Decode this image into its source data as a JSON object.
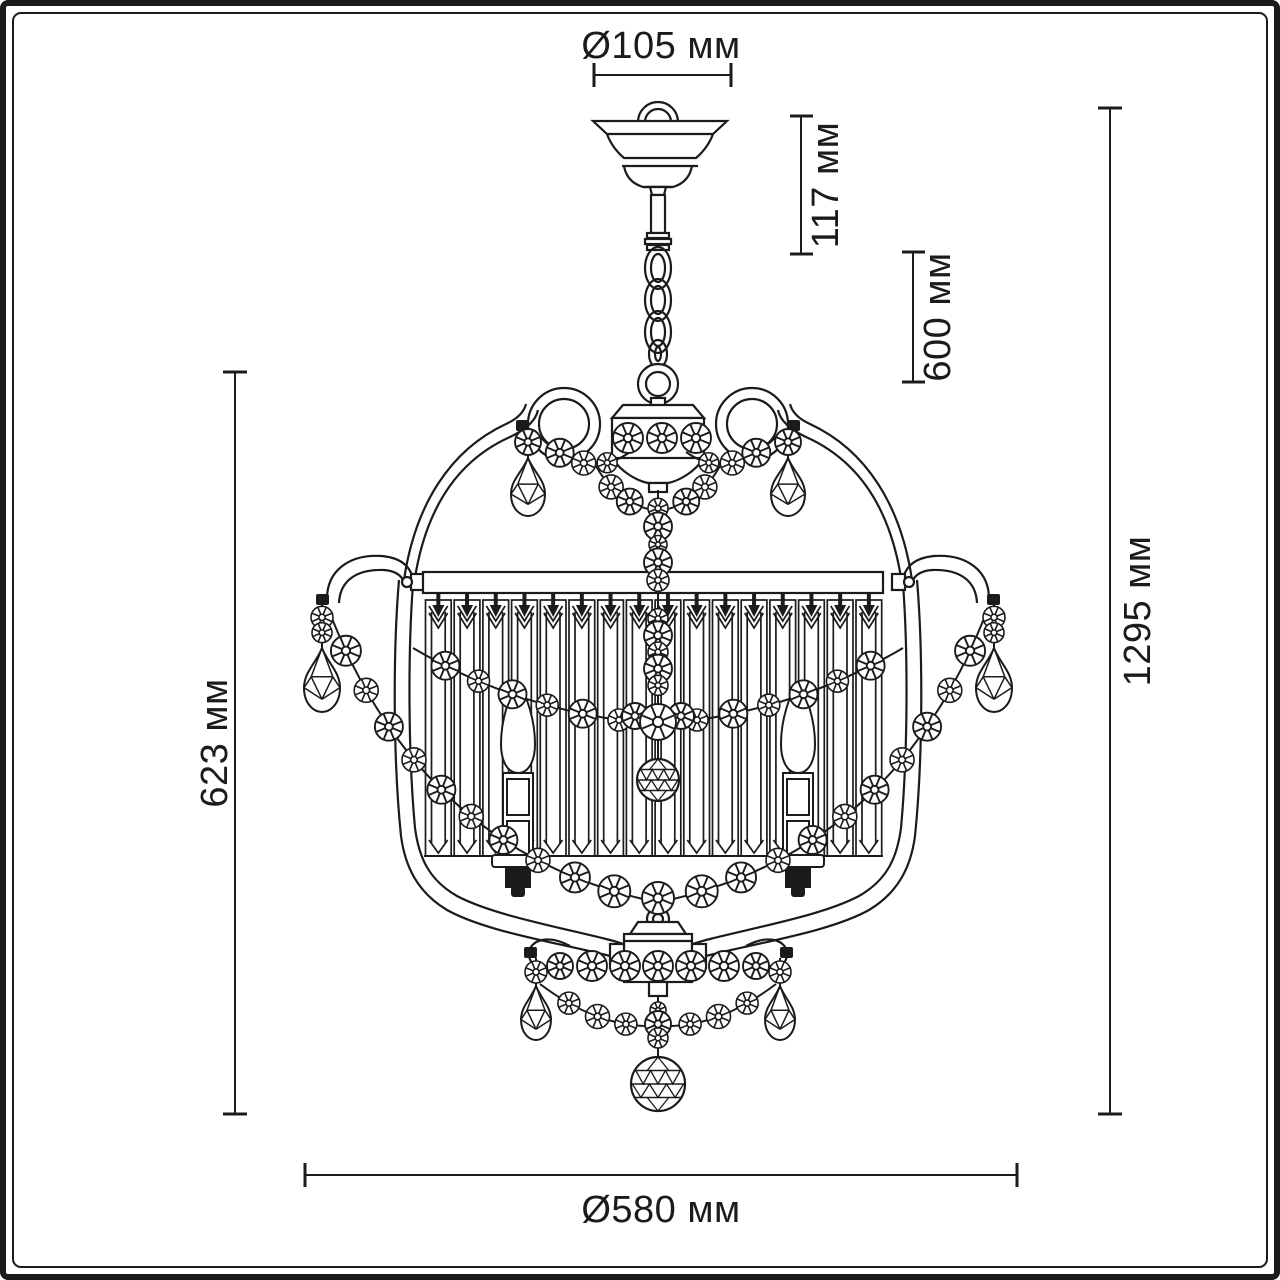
{
  "diagram": {
    "kind": "chandelier-technical-dimension-drawing",
    "ink_color": "#1b1b1b",
    "background_color": "#ffffff"
  },
  "dimensions": {
    "canopy_diameter": "Ø105 мм",
    "canopy_height": "117 мм",
    "suspension_length": "600 мм",
    "total_height": "1295 мм",
    "body_height": "623 мм",
    "body_diameter": "Ø580 мм"
  }
}
